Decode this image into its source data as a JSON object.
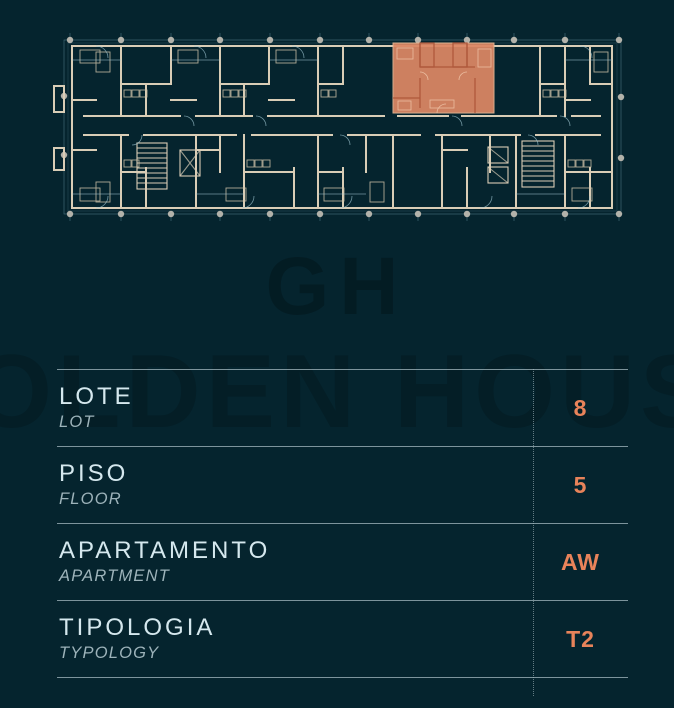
{
  "page": {
    "background": "#05242e"
  },
  "plan": {
    "description": "building-floor-plan-level",
    "highlighted_unit": "AW",
    "highlight_color": "#dd8764",
    "wall_color": "#d9cdb6",
    "detail_line_color": "#9fc6d2",
    "column_dot_color": "#b3b2aa"
  },
  "watermark": {
    "monogram": "GH",
    "brand": "GOLDEN HOUSE"
  },
  "details": {
    "rows": [
      {
        "label_pt": "LOTE",
        "label_en": "LOT",
        "value": "8"
      },
      {
        "label_pt": "PISO",
        "label_en": "FLOOR",
        "value": "5"
      },
      {
        "label_pt": "APARTAMENTO",
        "label_en": "APARTMENT",
        "value": "AW"
      },
      {
        "label_pt": "TIPOLOGIA",
        "label_en": "TYPOLOGY",
        "value": "T2"
      }
    ]
  },
  "colors": {
    "accent_orange": "#e8835a",
    "label_primary": "#d5e8ee",
    "label_secondary": "#9db3ba",
    "divider": "#b0c5cc"
  }
}
